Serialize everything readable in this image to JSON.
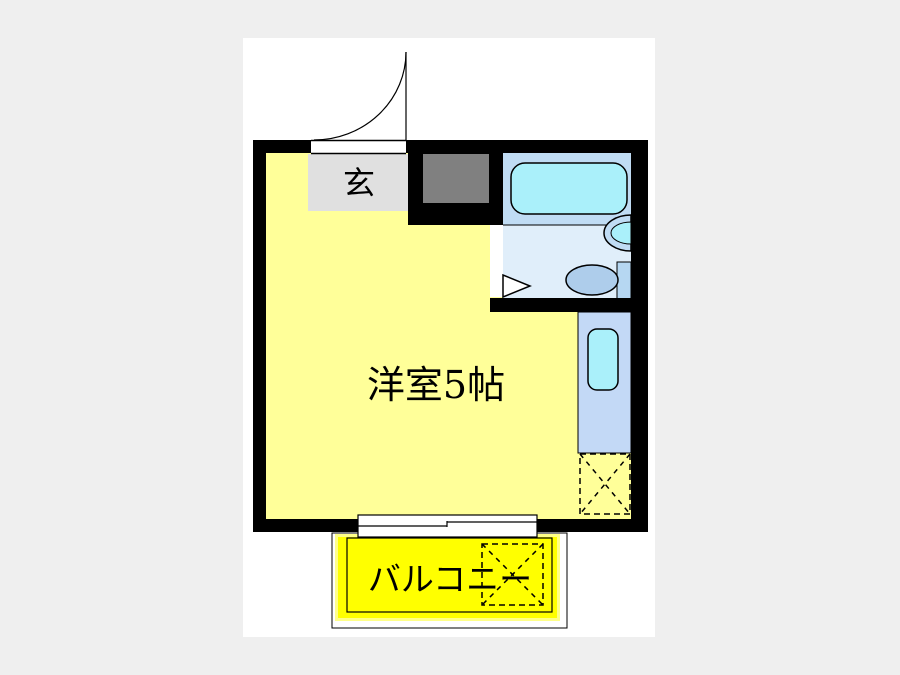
{
  "image_type": "japanese-apartment-floorplan",
  "labels": {
    "entrance": "玄",
    "main_room": "洋室5帖",
    "balcony": "バルコニー"
  },
  "colors": {
    "page_background": "#efefef",
    "canvas_background": "#ffffff",
    "wall": "#000000",
    "room_fill": "#ffff99",
    "entrance_fill": "#e0e0e0",
    "closet_fill": "#808080",
    "bath_zone_fill": "#c0dcf4",
    "washroom_fill": "#e0eefa",
    "fixture_cyan": "#aaf0fa",
    "toilet_fill": "#aecdeb",
    "toilet_tank_fill": "#b6d7f2",
    "kitchen_fill": "#c3d9f6",
    "balcony_fill": "#ffff00",
    "balcony_halo": "#ffff88",
    "opening_white": "#ffffff"
  }
}
